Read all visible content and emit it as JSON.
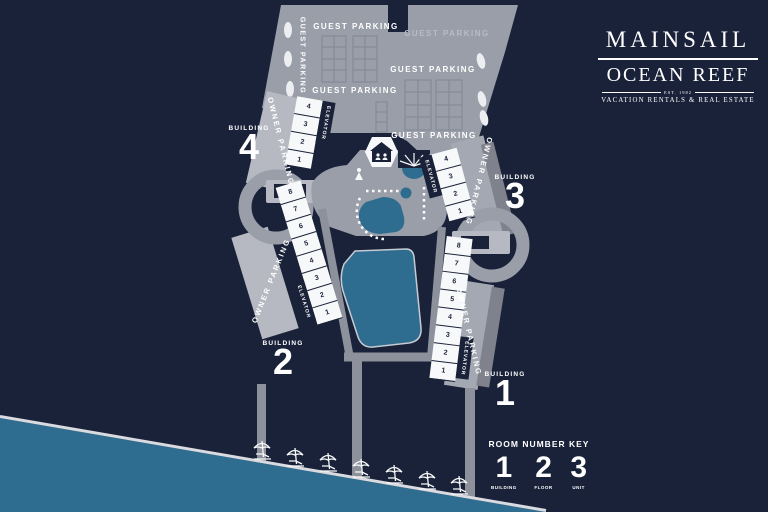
{
  "logo": {
    "brand": "MAINSAIL",
    "sub_brand": "OCEAN REEF",
    "established": "EST. 1982",
    "tagline": "VACATION RENTALS & REAL ESTATE"
  },
  "parking": {
    "guest_top_left": "GUEST PARKING",
    "guest_top_right": "GUEST PARKING",
    "guest_mid_right": "GUEST PARKING",
    "guest_mid_left": "GUEST PARKING",
    "guest_bottom_right": "GUEST PARKING",
    "guest_vertical": "GUEST PARKING",
    "owner": "OWNER PARKING",
    "elevator": "ELEVATOR"
  },
  "buildings": {
    "b4": {
      "label": "BUILDING",
      "number": "4",
      "stalls": [
        "4",
        "3",
        "2",
        "1"
      ]
    },
    "b3": {
      "label": "BUILDING",
      "number": "3",
      "stalls": [
        "4",
        "3",
        "2",
        "1"
      ]
    },
    "b2": {
      "label": "BUILDING",
      "number": "2",
      "stalls": [
        "8",
        "7",
        "6",
        "5",
        "4",
        "3",
        "2",
        "1"
      ]
    },
    "b1": {
      "label": "BUILDING",
      "number": "1",
      "stalls": [
        "8",
        "7",
        "6",
        "5",
        "4",
        "3",
        "2",
        "1"
      ]
    }
  },
  "room_number_key": {
    "title": "ROOM NUMBER KEY",
    "entries": [
      {
        "digit": "1",
        "label": "BUILDING"
      },
      {
        "digit": "2",
        "label": "FLOOR"
      },
      {
        "digit": "3",
        "label": "UNIT"
      }
    ]
  },
  "icons": {
    "clubhouse": "house-with-people-icon",
    "spa_canopy": "sunburst-canopy-icon",
    "beach": "umbrella-lounger-icon",
    "amenity": "person-icon"
  },
  "colors": {
    "background": "#1a2239",
    "lot_gray": "#9a9ea9",
    "light_gray": "#b6b9c1",
    "road_gray": "#8d919b",
    "dark_road": "#7f828d",
    "white": "#f7f8f9",
    "water_teal": "#2f6d90",
    "navy": "#1a2239"
  }
}
